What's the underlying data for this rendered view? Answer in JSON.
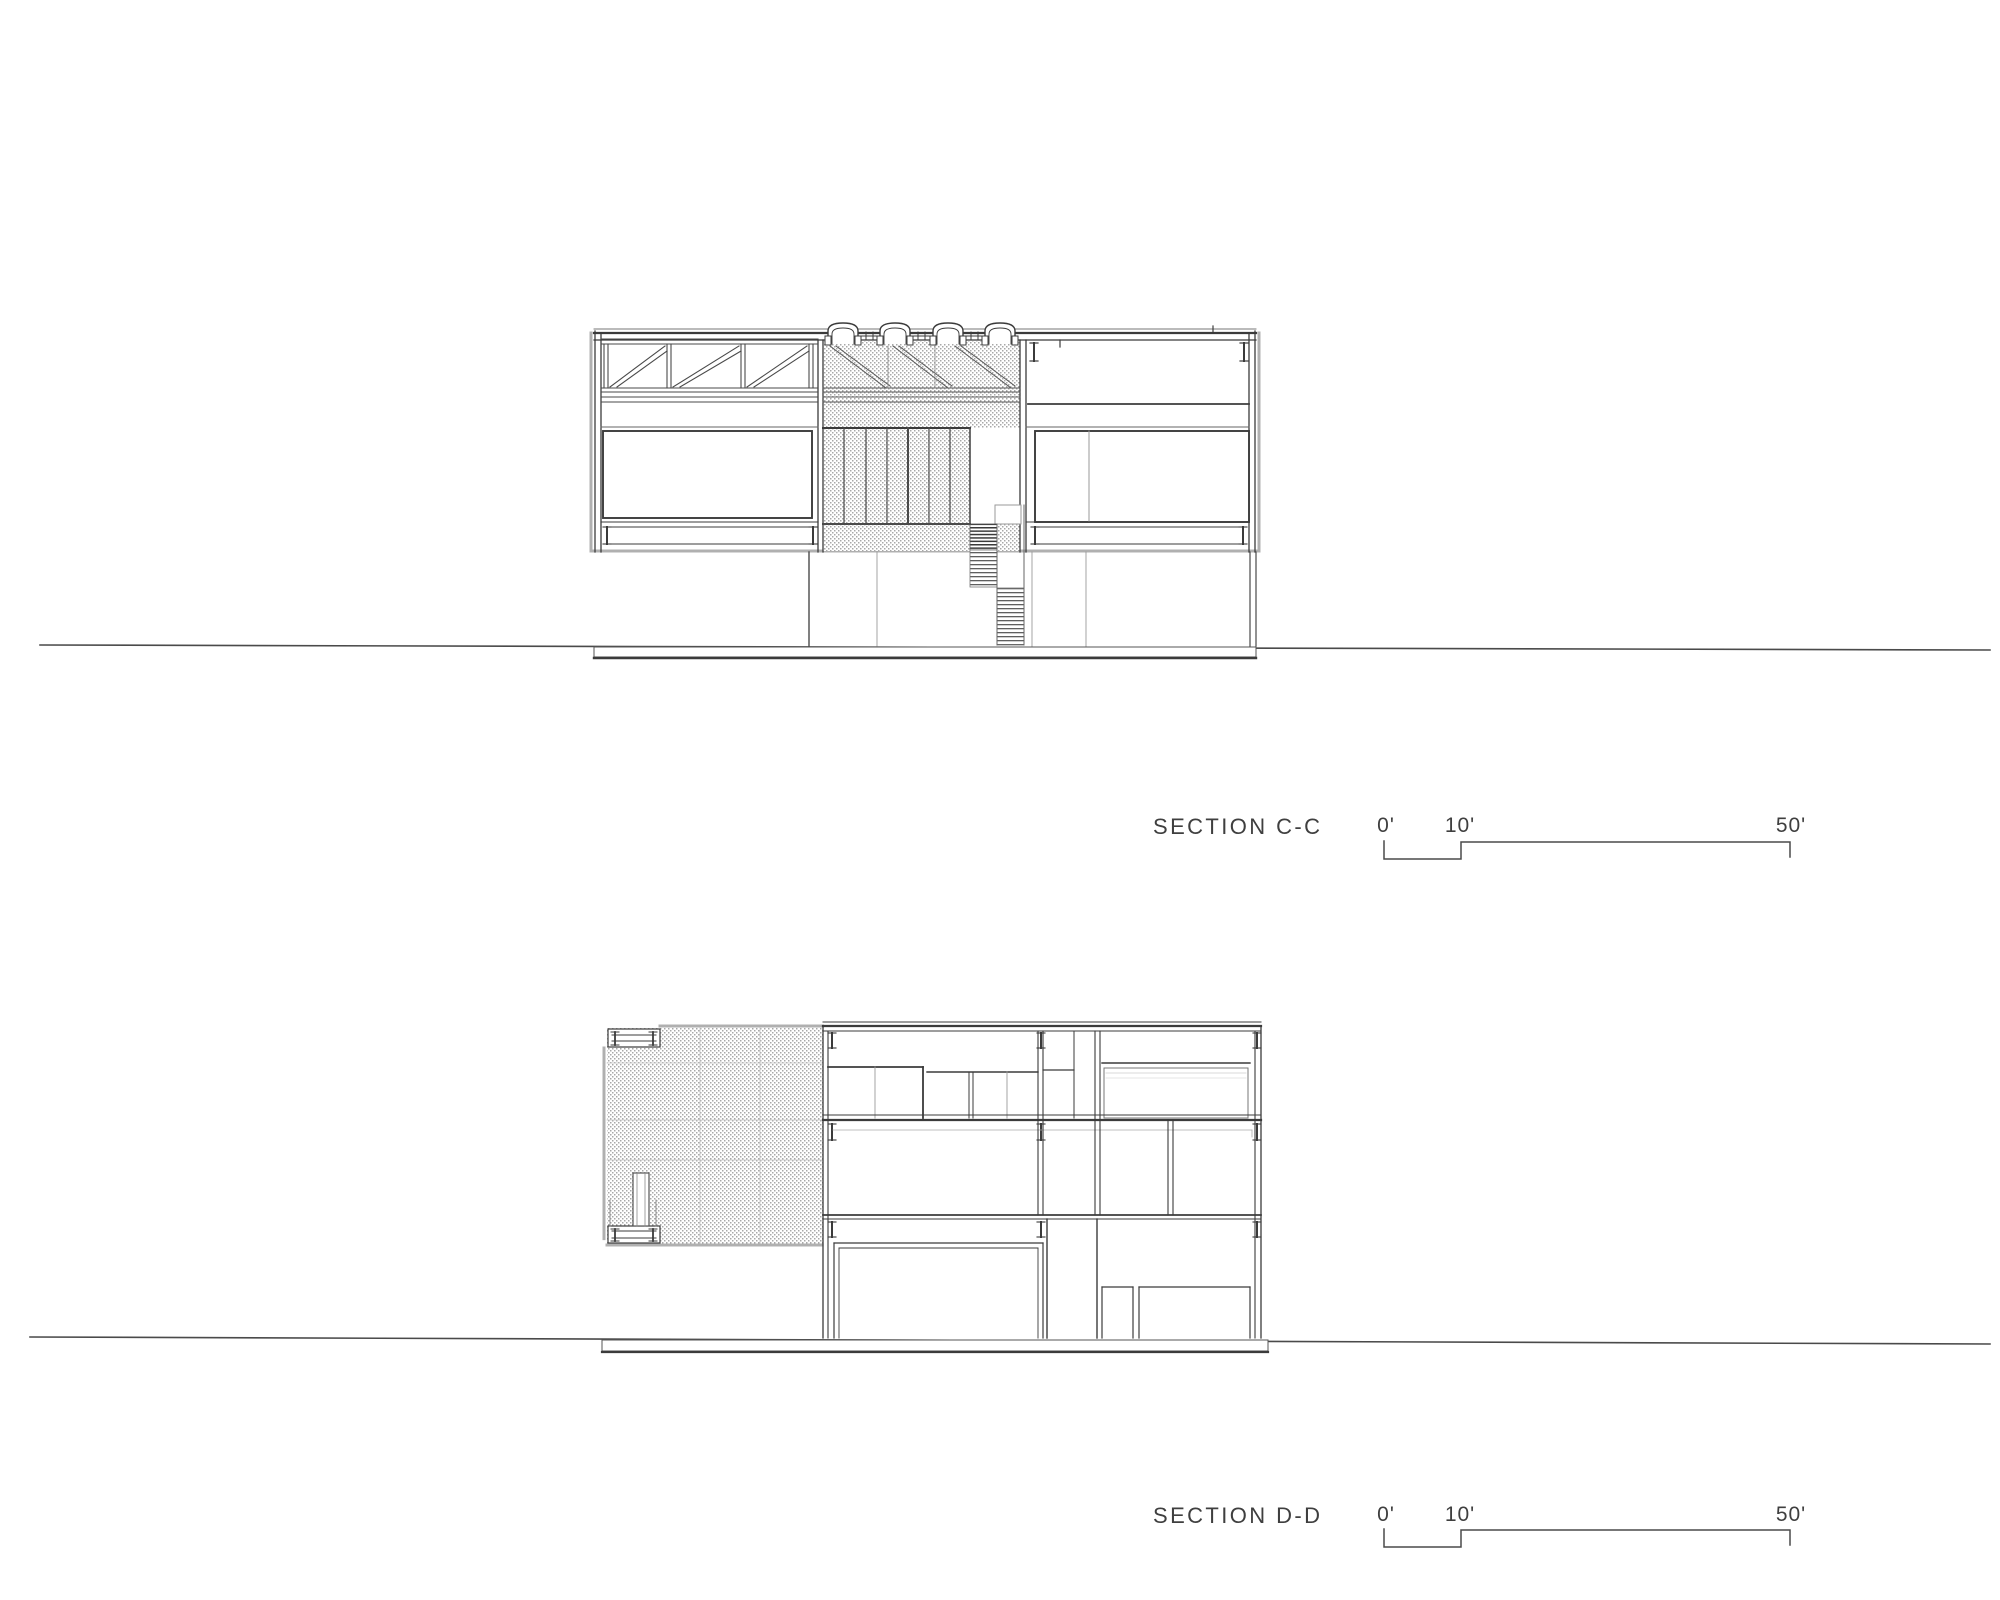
{
  "sheet": {
    "type": "architectural-section-sheet",
    "background": "#ffffff"
  },
  "sections": [
    {
      "id": "section-c-c",
      "label": "SECTION C-C",
      "scale_bar": {
        "tick_0": "0'",
        "tick_10": "10'",
        "tick_50": "50'"
      }
    },
    {
      "id": "section-d-d",
      "label": "SECTION D-D",
      "scale_bar": {
        "tick_0": "0'",
        "tick_10": "10'",
        "tick_50": "50'"
      }
    }
  ],
  "colors": {
    "line_dark": "#3b3b3b",
    "line_medium": "#5a5a5a",
    "line_light": "#949494",
    "hatch_gray": "#9e9e9e",
    "text": "#3f3f3f"
  }
}
